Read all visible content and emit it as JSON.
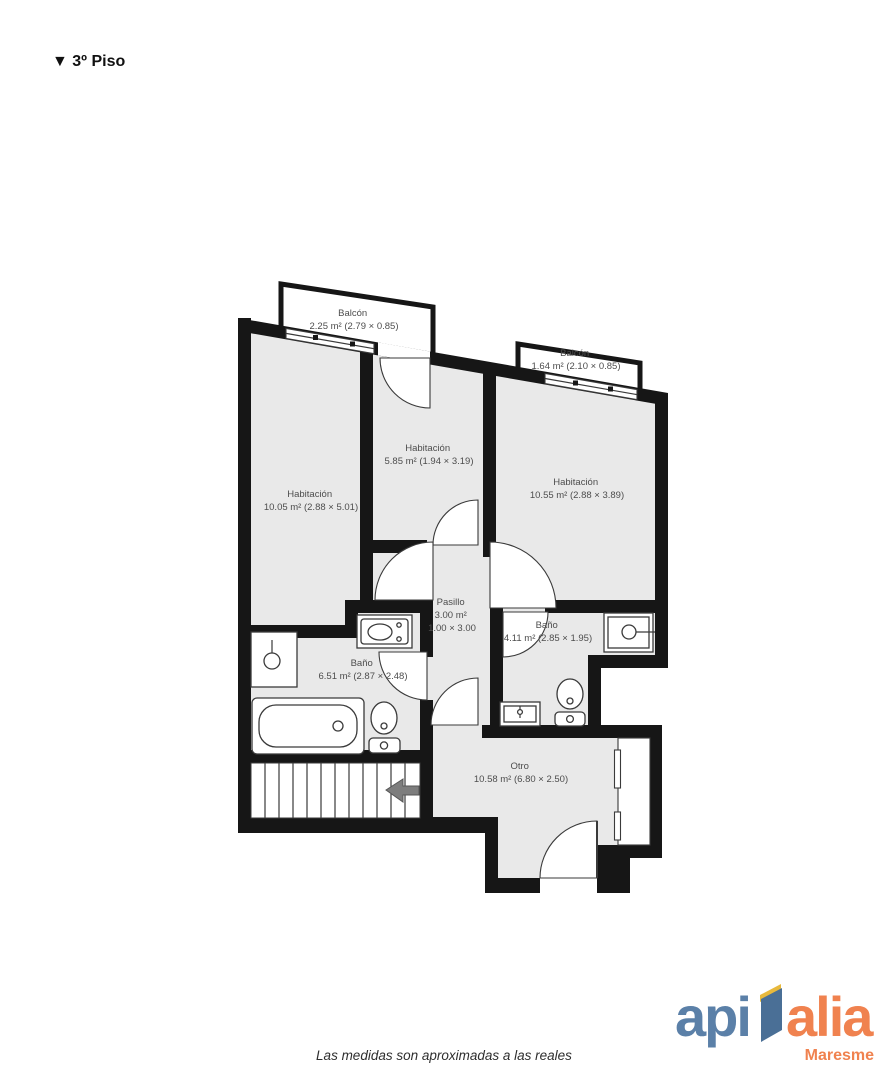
{
  "header": {
    "title": "▼ 3º Piso"
  },
  "plan": {
    "rooms": {
      "balcon_izq": {
        "name": "Balcón",
        "detail": "2.25 m² (2.79 × 0.85)"
      },
      "balcon_der": {
        "name": "Balcón",
        "detail": "1.64 m² (2.10 × 0.85)"
      },
      "habitacion_izq": {
        "name": "Habitación",
        "detail": "10.05 m² (2.88 × 5.01)"
      },
      "habitacion_centro": {
        "name": "Habitación",
        "detail": "5.85 m² (1.94 × 3.19)"
      },
      "habitacion_der": {
        "name": "Habitación",
        "detail": "10.55 m² (2.88 × 3.89)"
      },
      "pasillo": {
        "name": "Pasillo",
        "detail": "3.00 m²",
        "detail2": "1.00 × 3.00"
      },
      "bano_izq": {
        "name": "Baño",
        "detail": "6.51 m² (2.87 × 2.48)"
      },
      "bano_der": {
        "name": "Baño",
        "detail": "4.11 m² (2.85 × 1.95)"
      },
      "otro": {
        "name": "Otro",
        "detail": "10.58 m² (6.80 × 2.50)"
      }
    },
    "fixtures": [
      "shower",
      "vanity-sink",
      "bathtub",
      "toilet",
      "wall-sink",
      "stairs",
      "entry-door",
      "window-bay"
    ],
    "colors": {
      "wall": "#161616",
      "floor": "#e9e9e9",
      "line": "#3a3a3a",
      "label": "#4d4d4d"
    }
  },
  "footer": {
    "disclaimer": "Las medidas son aproximadas a las reales"
  },
  "logo": {
    "word_primary": "api",
    "word_secondary": "alia",
    "tagline": "Maresme",
    "blue": "#5b80a8",
    "orange": "#f0824f",
    "glyph_yellow": "#e8b93c",
    "glyph_blue": "#4a6f96"
  }
}
